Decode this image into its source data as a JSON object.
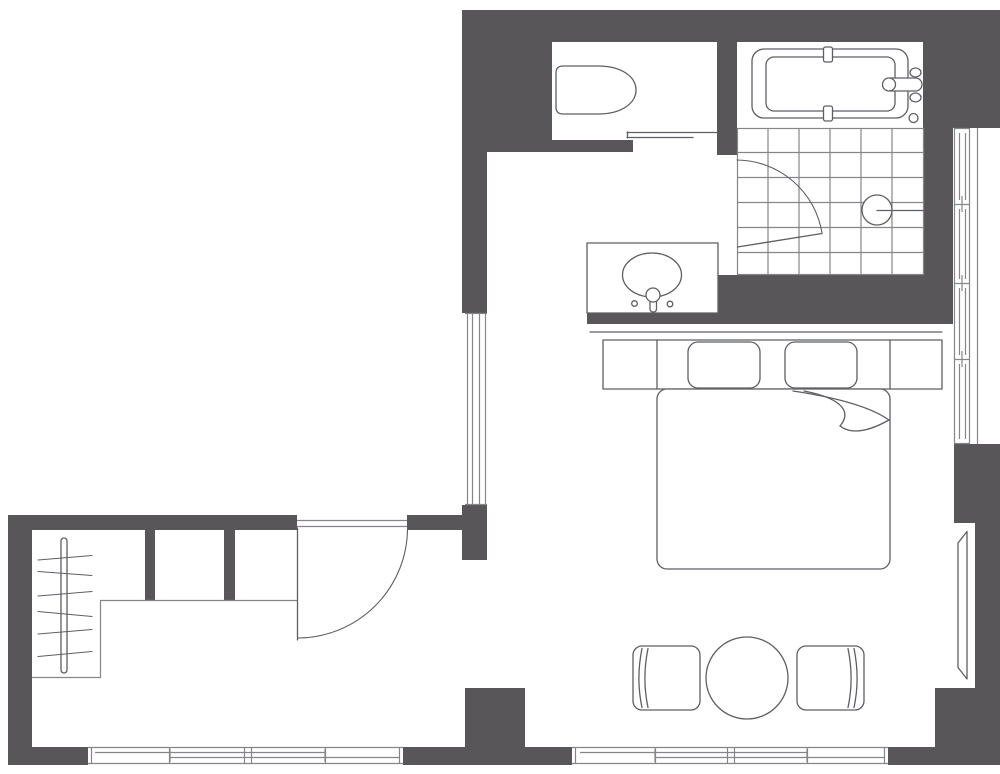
{
  "meta": {
    "title": "Studio apartment floor plan",
    "type": "floor-plan",
    "description": "Black-and-white architectural floor plan: bathroom with tub and tiled shower at top right, toilet room top left of wing, washbasin, double bed with two pillows, round table with two armchairs, entry hall with wardrobe rail and hangers"
  },
  "colors": {
    "wall": "#595659",
    "line": "#85868a",
    "line_dark": "#5e5f63",
    "background": "#ffffff"
  },
  "fixtures": [
    "exterior-walls",
    "entry-door",
    "toilet",
    "toilet-sliding-door",
    "bathtub",
    "tub-faucet",
    "shower-tiled-floor",
    "shower-door",
    "floor-drain",
    "washbasin-vanity",
    "basin-faucet",
    "double-bed",
    "headboard",
    "nightstands",
    "pillows",
    "mattress",
    "blanket-fold",
    "wardrobe-rail",
    "clothes-hangers",
    "closet-outline",
    "round-dining-table",
    "armchair-left",
    "armchair-right",
    "radiator-niche",
    "window-strips"
  ]
}
